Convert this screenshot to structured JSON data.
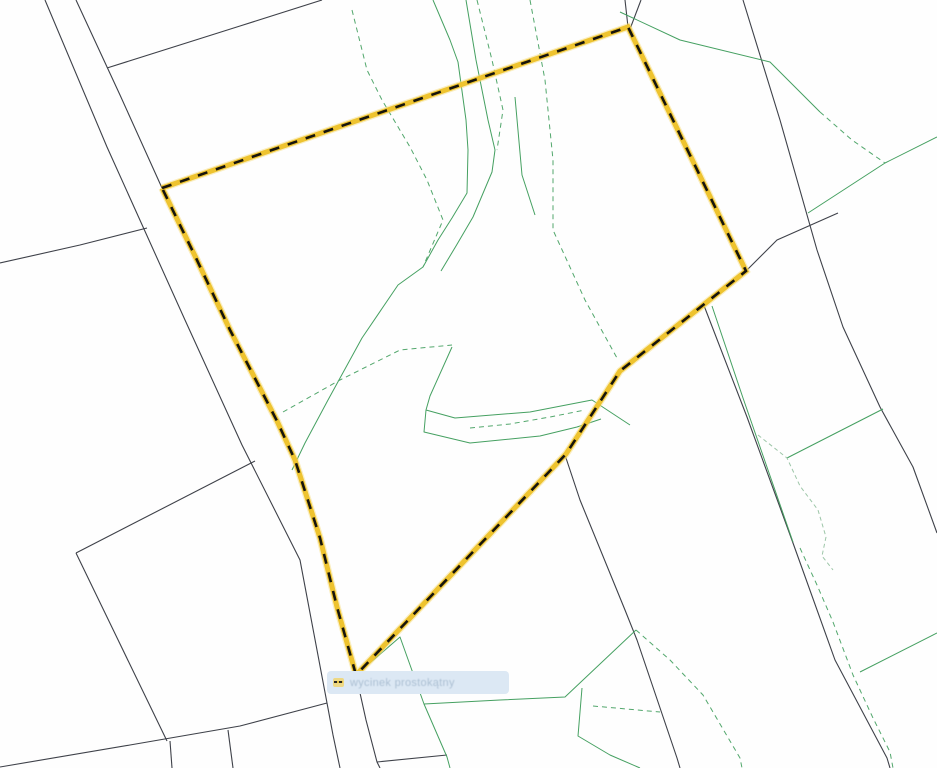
{
  "map": {
    "background": "#fefefe",
    "canvas": {
      "width": 937,
      "height": 768
    },
    "tooltip": {
      "label": "wycinek prostokątny",
      "bg": "#dce8f4",
      "text_color": "#a3b8cd",
      "icon_bg": "#efd77a",
      "x": 327,
      "y": 671,
      "width": 182,
      "height": 23
    },
    "selection": {
      "band_color": "#eec32f",
      "band_glow": "#f6dc77",
      "dash_color": "#17150c",
      "band_width": 5,
      "dash_width": 2.6,
      "dash_pattern": "10 9",
      "vertices": [
        [
          162,
          188
        ],
        [
          628,
          27
        ],
        [
          746,
          271
        ],
        [
          620,
          371
        ],
        [
          566,
          454
        ],
        [
          356,
          675
        ],
        [
          337,
          607
        ],
        [
          320,
          538
        ],
        [
          295,
          460
        ],
        [
          277,
          421
        ],
        [
          230,
          330
        ],
        [
          196,
          258
        ]
      ]
    },
    "line_groups": {
      "parcel-lines": {
        "color": "#3e4149",
        "width": 1.1,
        "dash": null,
        "polylines": [
          [
            [
              45,
              0
            ],
            [
              107,
              147
            ],
            [
              185,
              320
            ],
            [
              242,
              445
            ],
            [
              300,
              560
            ],
            [
              327,
              703
            ]
          ],
          [
            [
              76,
              0
            ],
            [
              120,
              95
            ],
            [
              162,
              188
            ]
          ],
          [
            [
              322,
              0
            ],
            [
              240,
              26
            ],
            [
              107,
              68
            ]
          ],
          [
            [
              0,
              263
            ],
            [
              80,
              245
            ],
            [
              147,
              228
            ]
          ],
          [
            [
              327,
              703
            ],
            [
              240,
              726
            ],
            [
              130,
              745
            ],
            [
              0,
              767
            ]
          ],
          [
            [
              327,
              703
            ],
            [
              333,
              735
            ],
            [
              340,
              768
            ]
          ],
          [
            [
              356,
              675
            ],
            [
              366,
              720
            ],
            [
              377,
              762
            ],
            [
              380,
              768
            ]
          ],
          [
            [
              76,
              553
            ],
            [
              255,
              461
            ]
          ],
          [
            [
              76,
              553
            ],
            [
              167,
              741
            ]
          ],
          [
            [
              170,
              741
            ],
            [
              172,
              768
            ]
          ],
          [
            [
              228,
              730
            ],
            [
              233,
              768
            ]
          ],
          [
            [
              377,
              762
            ],
            [
              447,
              755
            ]
          ],
          [
            [
              625,
              0
            ],
            [
              628,
              27
            ]
          ],
          [
            [
              641,
              0
            ],
            [
              630,
              29
            ]
          ],
          [
            [
              743,
              0
            ],
            [
              780,
              120
            ],
            [
              817,
              250
            ],
            [
              843,
              327
            ],
            [
              880,
              407
            ],
            [
              913,
              467
            ],
            [
              937,
              533
            ]
          ],
          [
            [
              746,
              271
            ],
            [
              777,
              240
            ],
            [
              838,
              213
            ]
          ],
          [
            [
              565,
              455
            ],
            [
              580,
              500
            ],
            [
              625,
              610
            ],
            [
              637,
              640
            ],
            [
              677,
              758
            ],
            [
              680,
              768
            ]
          ],
          [
            [
              703,
              303
            ],
            [
              747,
              417
            ],
            [
              793,
              543
            ],
            [
              835,
              660
            ],
            [
              887,
              758
            ],
            [
              890,
              768
            ]
          ]
        ]
      },
      "green-solid-lines": {
        "color": "#45a061",
        "width": 1,
        "dash": null,
        "polylines": [
          [
            [
              433,
              0
            ],
            [
              450,
              40
            ],
            [
              458,
              62
            ],
            [
              466,
              120
            ],
            [
              468,
              150
            ],
            [
              467,
              193
            ],
            [
              452,
              218
            ],
            [
              438,
              240
            ],
            [
              423,
              267
            ],
            [
              398,
              285
            ],
            [
              362,
              338
            ],
            [
              328,
              400
            ],
            [
              305,
              443
            ],
            [
              292,
              470
            ]
          ],
          [
            [
              466,
              0
            ],
            [
              476,
              60
            ],
            [
              488,
              120
            ],
            [
              495,
              150
            ],
            [
              492,
              172
            ],
            [
              473,
              217
            ],
            [
              456,
              246
            ],
            [
              441,
              271
            ]
          ],
          [
            [
              452,
              347
            ],
            [
              430,
              396
            ],
            [
              426,
              410
            ],
            [
              455,
              418
            ],
            [
              530,
              412
            ],
            [
              592,
              400
            ],
            [
              630,
              425
            ]
          ],
          [
            [
              426,
              410
            ],
            [
              424,
              432
            ],
            [
              470,
              443
            ],
            [
              540,
              436
            ],
            [
              577,
              427
            ],
            [
              601,
              419
            ]
          ],
          [
            [
              620,
              12
            ],
            [
              680,
              40
            ],
            [
              770,
              62
            ],
            [
              820,
              112
            ]
          ],
          [
            [
              808,
              213
            ],
            [
              885,
              163
            ],
            [
              937,
              137
            ]
          ],
          [
            [
              883,
              409
            ],
            [
              787,
              458
            ]
          ],
          [
            [
              712,
              306
            ],
            [
              743,
              398
            ],
            [
              793,
              542
            ]
          ],
          [
            [
              937,
              633
            ],
            [
              860,
              672
            ]
          ],
          [
            [
              356,
              675
            ],
            [
              400,
              637
            ],
            [
              424,
              704
            ],
            [
              447,
              757
            ],
            [
              450,
              768
            ]
          ],
          [
            [
              424,
              704
            ],
            [
              500,
              700
            ],
            [
              565,
              697
            ],
            [
              636,
              630
            ]
          ],
          [
            [
              582,
              688
            ],
            [
              578,
              736
            ],
            [
              610,
              755
            ],
            [
              640,
              768
            ]
          ],
          [
            [
              515,
              97
            ],
            [
              522,
              175
            ],
            [
              535,
              215
            ]
          ]
        ]
      },
      "green-dashed-lines": {
        "color": "#52a76c",
        "width": 1,
        "dash": "5 4",
        "polylines": [
          [
            [
              352,
              10
            ],
            [
              367,
              70
            ],
            [
              382,
              100
            ],
            [
              410,
              147
            ],
            [
              427,
              180
            ],
            [
              443,
              220
            ],
            [
              423,
              267
            ]
          ],
          [
            [
              530,
              0
            ],
            [
              545,
              80
            ],
            [
              553,
              160
            ],
            [
              553,
              230
            ],
            [
              585,
              300
            ],
            [
              617,
              358
            ]
          ],
          [
            [
              283,
              412
            ],
            [
              340,
              380
            ],
            [
              400,
              350
            ],
            [
              452,
              345
            ]
          ],
          [
            [
              820,
              112
            ],
            [
              852,
              140
            ],
            [
              885,
              163
            ]
          ],
          [
            [
              800,
              548
            ],
            [
              817,
              585
            ],
            [
              833,
              622
            ],
            [
              853,
              675
            ],
            [
              873,
              718
            ],
            [
              890,
              752
            ],
            [
              893,
              768
            ]
          ],
          [
            [
              636,
              630
            ],
            [
              670,
              660
            ],
            [
              703,
              695
            ],
            [
              740,
              758
            ],
            [
              742,
              768
            ]
          ],
          [
            [
              593,
              706
            ],
            [
              660,
              712
            ]
          ],
          [
            [
              470,
              428
            ],
            [
              510,
              424
            ],
            [
              550,
              417
            ],
            [
              585,
              410
            ]
          ],
          [
            [
              477,
              0
            ],
            [
              492,
              60
            ],
            [
              503,
              110
            ],
            [
              497,
              150
            ]
          ]
        ]
      },
      "green-faint-dashed-lines": {
        "color": "#9dc6a8",
        "width": 1,
        "dash": "4 3",
        "polylines": [
          [
            [
              758,
              435
            ],
            [
              787,
              458
            ],
            [
              800,
              486
            ],
            [
              818,
              510
            ],
            [
              826,
              537
            ],
            [
              822,
              556
            ],
            [
              833,
              570
            ]
          ]
        ]
      }
    }
  }
}
